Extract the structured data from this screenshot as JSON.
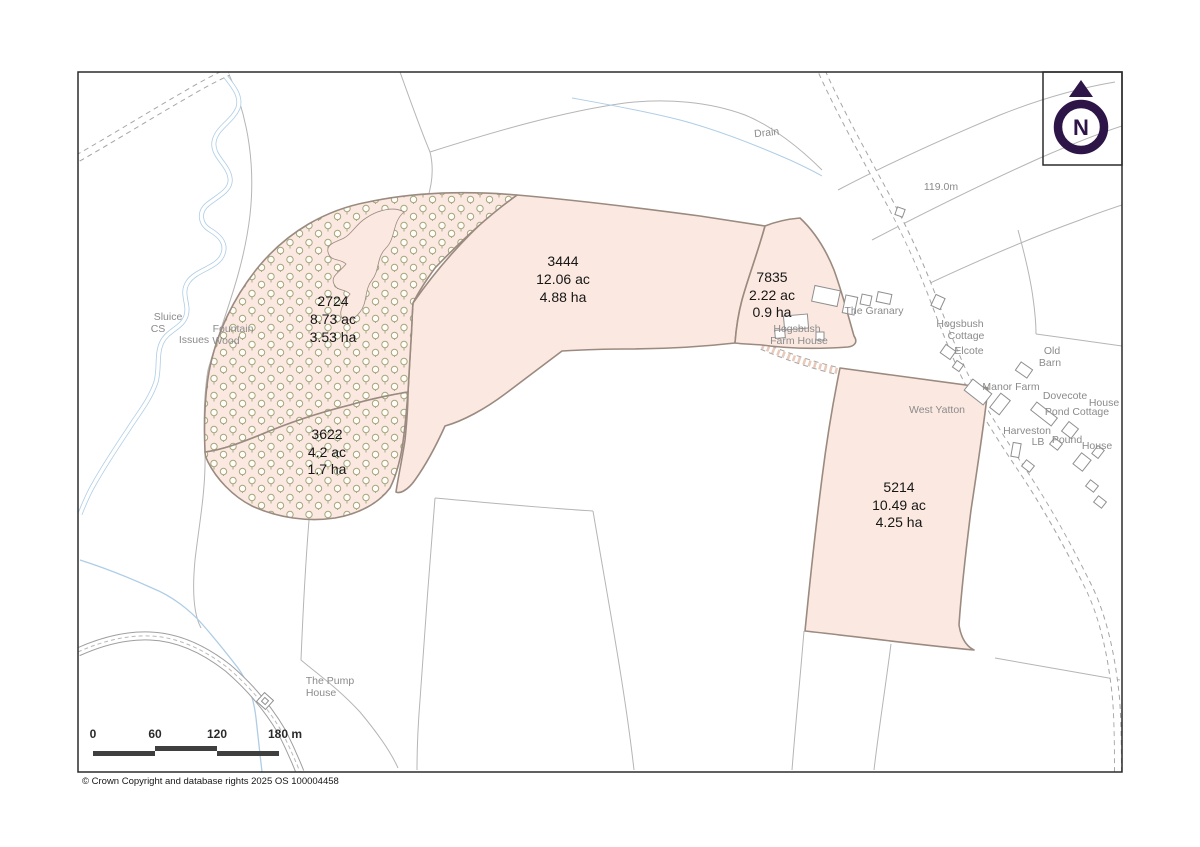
{
  "map": {
    "copyright": "© Crown Copyright and database rights 2025 OS 100004458",
    "compass": {
      "letter": "N"
    },
    "scale_bar": {
      "ticks": [
        "0",
        "60",
        "120",
        "180 m"
      ]
    },
    "parcels": [
      {
        "number": "3444",
        "acres": "12.06 ac",
        "hectares": "4.88 ha",
        "type": "field"
      },
      {
        "number": "7835",
        "acres": "2.22 ac",
        "hectares": "0.9 ha",
        "type": "field"
      },
      {
        "number": "5214",
        "acres": "10.49 ac",
        "hectares": "4.25 ha",
        "type": "field"
      },
      {
        "number": "2724",
        "acres": "8.73 ac",
        "hectares": "3.53 ha",
        "type": "woodland"
      },
      {
        "number": "3622",
        "acres": "4.2 ac",
        "hectares": "1.7 ha",
        "type": "woodland"
      }
    ],
    "place_labels": [
      {
        "text": "Drain"
      },
      {
        "text": "119.0m"
      },
      {
        "text": "Sluice"
      },
      {
        "text": "CS"
      },
      {
        "text": "Issues"
      },
      {
        "text": "Fountain"
      },
      {
        "text": "Wood"
      },
      {
        "text": "The Granary"
      },
      {
        "text": "Hogsbush"
      },
      {
        "text": "Cottage"
      },
      {
        "text": "Elcote"
      },
      {
        "text": "Hogsbush"
      },
      {
        "text": "Farm House"
      },
      {
        "text": "Old"
      },
      {
        "text": "Barn"
      },
      {
        "text": "Manor Farm"
      },
      {
        "text": "Dovecote"
      },
      {
        "text": "House"
      },
      {
        "text": "Pond Cottage"
      },
      {
        "text": "Harveston"
      },
      {
        "text": "LB"
      },
      {
        "text": "Pound"
      },
      {
        "text": "House"
      },
      {
        "text": "West Yatton"
      },
      {
        "text": "The Pump"
      },
      {
        "text": "House"
      }
    ],
    "colors": {
      "parcel_fill": "#fbe9e1",
      "parcel_outline": "#9b8a7f",
      "woodland_symbol": "#a5a67e",
      "water": "#aecde6",
      "field_line": "#b5b5b5",
      "label_gray": "#8b8b8b",
      "hatch_pink": "#e9c9ba",
      "north_purple": "#2e1547"
    }
  }
}
